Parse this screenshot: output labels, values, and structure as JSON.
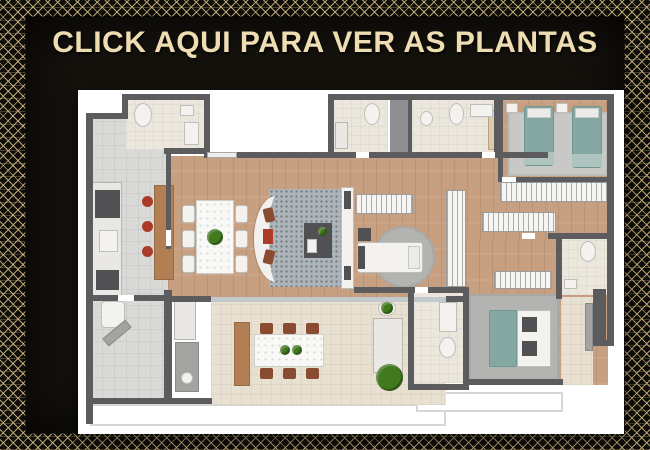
{
  "banner": {
    "cta_label": "CLICK AQUI PARA VER AS PLANTAS"
  },
  "palette": {
    "gold-text": "#efddb2",
    "gold-line": "#cbb47e",
    "panel-bg": "#16130e",
    "wall": "#5c5c5e",
    "wood": "#c79f81",
    "tile": "#d9d9d7",
    "bath": "#ece7dc",
    "terrace": "#e8e0d0",
    "bed-teal": "#86a8a2",
    "chair-brown": "#8a4c31",
    "stool-red": "#ab3a29",
    "plant-green": "#41791f",
    "wood-furniture": "#b17f53"
  },
  "floorplan": {
    "description": "apartment floor plan, top view",
    "items": [
      {
        "n": "balcony-apron-left",
        "t": "apron",
        "x": 12,
        "y": 314,
        "w": 356,
        "h": 22
      },
      {
        "n": "balcony-apron-right",
        "t": "apron",
        "x": 338,
        "y": 302,
        "w": 147,
        "h": 20
      },
      {
        "n": "entry-hall-floor",
        "t": "tile",
        "x": 12,
        "y": 27,
        "w": 114,
        "h": 37
      },
      {
        "n": "kitchen-floor",
        "t": "tile",
        "x": 12,
        "y": 27,
        "w": 80,
        "h": 185
      },
      {
        "n": "lavabo-floor",
        "t": "bath",
        "x": 48,
        "y": 8,
        "w": 80,
        "h": 52
      },
      {
        "n": "living-dining-floor",
        "t": "wood",
        "x": 90,
        "y": 66,
        "w": 446,
        "h": 146
      },
      {
        "n": "twin-bedroom-floor",
        "t": "wood",
        "x": 424,
        "y": 8,
        "w": 108,
        "h": 82
      },
      {
        "n": "master-suite-floor",
        "t": "wood",
        "x": 388,
        "y": 150,
        "w": 142,
        "h": 145
      },
      {
        "n": "service-area-floor",
        "t": "tile",
        "x": 12,
        "y": 200,
        "w": 76,
        "h": 112
      },
      {
        "n": "terrace-floor",
        "t": "terr",
        "x": 133,
        "y": 212,
        "w": 235,
        "h": 103
      },
      {
        "n": "bathroom1-floor",
        "t": "bath",
        "x": 255,
        "y": 10,
        "w": 55,
        "h": 54
      },
      {
        "n": "shaft",
        "t": "shaft",
        "x": 312,
        "y": 10,
        "w": 20,
        "h": 54
      },
      {
        "n": "bathroom2-floor",
        "t": "bath",
        "x": 334,
        "y": 10,
        "w": 82,
        "h": 54
      },
      {
        "n": "office-bathroom-floor",
        "t": "bath",
        "x": 334,
        "y": 200,
        "w": 52,
        "h": 93
      },
      {
        "n": "master-bathroom-floor",
        "t": "bath",
        "x": 481,
        "y": 147,
        "w": 51,
        "h": 58
      },
      {
        "n": "master-balcony-floor",
        "t": "terr",
        "x": 483,
        "y": 207,
        "w": 32,
        "h": 88
      },
      {
        "n": "living-rug",
        "t": "rugdot",
        "x": 191,
        "y": 99,
        "w": 76,
        "h": 98
      },
      {
        "n": "twin-bedroom-rug",
        "t": "ruggray",
        "x": 430,
        "y": 22,
        "w": 100,
        "h": 64
      },
      {
        "n": "office-rug",
        "t": "rugm",
        "x": 295,
        "y": 136,
        "w": 62,
        "h": 62,
        "r": "50%"
      },
      {
        "n": "master-rug",
        "t": "rugm",
        "x": 391,
        "y": 204,
        "w": 90,
        "h": 88
      },
      {
        "n": "terrace-sliding-door",
        "t": "glass",
        "x": 133,
        "y": 207,
        "w": 235,
        "h": 5
      },
      {
        "n": "toilet",
        "t": "white",
        "x": 56,
        "y": 13,
        "w": 18,
        "h": 24,
        "r": "50%"
      },
      {
        "n": "sink",
        "t": "white",
        "x": 102,
        "y": 15,
        "w": 14,
        "h": 11
      },
      {
        "n": "bathtub",
        "t": "white",
        "x": 106,
        "y": 32,
        "w": 15,
        "h": 23
      },
      {
        "n": "kitchen-counter",
        "t": "counter",
        "x": 14,
        "y": 92,
        "w": 30,
        "h": 116
      },
      {
        "n": "stove",
        "t": "dark",
        "x": 17,
        "y": 100,
        "w": 25,
        "h": 28
      },
      {
        "n": "kitchen-sink",
        "t": "white",
        "x": 21,
        "y": 140,
        "w": 19,
        "h": 22
      },
      {
        "n": "oven",
        "t": "dark",
        "x": 18,
        "y": 180,
        "w": 23,
        "h": 20
      },
      {
        "n": "kitchen-island",
        "t": "woodf",
        "x": 76,
        "y": 95,
        "w": 20,
        "h": 95
      },
      {
        "n": "stool",
        "t": "red",
        "x": 64,
        "y": 106,
        "w": 11,
        "h": 11,
        "r": "50%"
      },
      {
        "n": "stool",
        "t": "red",
        "x": 64,
        "y": 131,
        "w": 11,
        "h": 11,
        "r": "50%"
      },
      {
        "n": "stool",
        "t": "red",
        "x": 64,
        "y": 156,
        "w": 11,
        "h": 11,
        "r": "50%"
      },
      {
        "n": "dining-chair",
        "t": "white",
        "x": 104,
        "y": 115,
        "w": 13,
        "h": 18,
        "r": 3
      },
      {
        "n": "dining-chair",
        "t": "white",
        "x": 104,
        "y": 140,
        "w": 13,
        "h": 18,
        "r": 3
      },
      {
        "n": "dining-chair",
        "t": "white",
        "x": 104,
        "y": 165,
        "w": 13,
        "h": 18,
        "r": 3
      },
      {
        "n": "dining-chair",
        "t": "white",
        "x": 157,
        "y": 115,
        "w": 13,
        "h": 18,
        "r": 3
      },
      {
        "n": "dining-chair",
        "t": "white",
        "x": 157,
        "y": 140,
        "w": 13,
        "h": 18,
        "r": 3
      },
      {
        "n": "dining-chair",
        "t": "white",
        "x": 157,
        "y": 165,
        "w": 13,
        "h": 18,
        "r": 3
      },
      {
        "n": "dining-table",
        "t": "marble",
        "x": 118,
        "y": 110,
        "w": 38,
        "h": 74
      },
      {
        "n": "centerpiece-plant",
        "t": "green",
        "x": 129,
        "y": 139,
        "w": 16,
        "h": 16
      },
      {
        "n": "curved-sofa",
        "t": "sofa",
        "x": 176,
        "y": 106,
        "w": 44,
        "h": 86
      },
      {
        "n": "sofa-cushion",
        "t": "brown",
        "x": 186,
        "y": 118,
        "w": 10,
        "h": 14,
        "rot": -14
      },
      {
        "n": "sofa-cushion",
        "t": "red",
        "x": 185,
        "y": 139,
        "w": 10,
        "h": 15
      },
      {
        "n": "sofa-cushion",
        "t": "brown",
        "x": 186,
        "y": 160,
        "w": 10,
        "h": 14,
        "rot": 14
      },
      {
        "n": "armchair-set",
        "t": "dark",
        "x": 226,
        "y": 133,
        "w": 28,
        "h": 35
      },
      {
        "n": "side-plant",
        "t": "green",
        "x": 240,
        "y": 137,
        "w": 9,
        "h": 9
      },
      {
        "n": "coffee-table",
        "t": "white",
        "x": 229,
        "y": 149,
        "w": 10,
        "h": 14
      },
      {
        "n": "tv-panel",
        "t": "white",
        "x": 263,
        "y": 97,
        "w": 13,
        "h": 102
      },
      {
        "n": "tv",
        "t": "dark",
        "x": 266,
        "y": 101,
        "w": 7,
        "h": 18
      },
      {
        "n": "tv-console",
        "t": "dark",
        "x": 266,
        "y": 176,
        "w": 7,
        "h": 14
      },
      {
        "n": "wardrobe",
        "t": "hatch",
        "x": 277,
        "y": 104,
        "w": 58,
        "h": 20
      },
      {
        "n": "desk",
        "t": "dark",
        "x": 280,
        "y": 138,
        "w": 13,
        "h": 13
      },
      {
        "n": "single-bed",
        "t": "white",
        "x": 279,
        "y": 152,
        "w": 66,
        "h": 31,
        "r": 3
      },
      {
        "n": "bed-footboard",
        "t": "dark",
        "x": 280,
        "y": 156,
        "w": 7,
        "h": 23
      },
      {
        "n": "bed-pillow",
        "t": "pillow",
        "x": 330,
        "y": 156,
        "w": 12,
        "h": 23
      },
      {
        "n": "tall-closet",
        "t": "hatch",
        "x": 368,
        "y": 100,
        "w": 20,
        "h": 97
      },
      {
        "n": "dresser",
        "t": "woodlight",
        "x": 410,
        "y": 20,
        "w": 12,
        "h": 40
      },
      {
        "n": "twin-bed",
        "t": "teal",
        "x": 446,
        "y": 16,
        "w": 30,
        "h": 60,
        "r": 3
      },
      {
        "n": "bed-pillow",
        "t": "pillow",
        "x": 449,
        "y": 18,
        "w": 24,
        "h": 10
      },
      {
        "n": "bed-foot-blanket",
        "t": "tealL",
        "x": 446,
        "y": 62,
        "w": 30,
        "h": 13
      },
      {
        "n": "twin-bed",
        "t": "teal",
        "x": 494,
        "y": 16,
        "w": 30,
        "h": 62,
        "r": 3
      },
      {
        "n": "bed-pillow",
        "t": "pillow",
        "x": 497,
        "y": 18,
        "w": 24,
        "h": 10
      },
      {
        "n": "bed-foot-blanket",
        "t": "tealL",
        "x": 494,
        "y": 64,
        "w": 30,
        "h": 13
      },
      {
        "n": "nightstand",
        "t": "white",
        "x": 428,
        "y": 13,
        "w": 12,
        "h": 10
      },
      {
        "n": "nightstand",
        "t": "white",
        "x": 478,
        "y": 13,
        "w": 12,
        "h": 10
      },
      {
        "n": "wardrobe",
        "t": "hatch",
        "x": 422,
        "y": 92,
        "w": 109,
        "h": 20
      },
      {
        "n": "wardrobe",
        "t": "hatch",
        "x": 404,
        "y": 122,
        "w": 74,
        "h": 20
      },
      {
        "n": "toilet",
        "t": "white",
        "x": 286,
        "y": 13,
        "w": 16,
        "h": 22,
        "r": "50%"
      },
      {
        "n": "shower",
        "t": "counter",
        "x": 257,
        "y": 32,
        "w": 13,
        "h": 27
      },
      {
        "n": "sink",
        "t": "white",
        "x": 342,
        "y": 21,
        "w": 13,
        "h": 15,
        "r": "50%"
      },
      {
        "n": "toilet",
        "t": "white",
        "x": 371,
        "y": 13,
        "w": 15,
        "h": 22,
        "r": "50%"
      },
      {
        "n": "vanity-counter",
        "t": "white",
        "x": 392,
        "y": 14,
        "w": 23,
        "h": 13
      },
      {
        "n": "vanity-counter",
        "t": "white",
        "x": 361,
        "y": 212,
        "w": 18,
        "h": 30
      },
      {
        "n": "toilet",
        "t": "white",
        "x": 361,
        "y": 247,
        "w": 17,
        "h": 21,
        "r": "50%"
      },
      {
        "n": "toilet",
        "t": "white",
        "x": 502,
        "y": 151,
        "w": 16,
        "h": 21,
        "r": "50%"
      },
      {
        "n": "sink",
        "t": "white",
        "x": 486,
        "y": 189,
        "w": 13,
        "h": 10
      },
      {
        "n": "wardrobe",
        "t": "hatch",
        "x": 416,
        "y": 181,
        "w": 58,
        "h": 18
      },
      {
        "n": "double-bed-duvet",
        "t": "teal",
        "x": 411,
        "y": 220,
        "w": 28,
        "h": 57,
        "r": 2
      },
      {
        "n": "double-bed",
        "t": "white",
        "x": 439,
        "y": 220,
        "w": 34,
        "h": 57
      },
      {
        "n": "bed-cushion",
        "t": "dark",
        "x": 444,
        "y": 227,
        "w": 15,
        "h": 15
      },
      {
        "n": "bed-cushion",
        "t": "dark",
        "x": 444,
        "y": 251,
        "w": 15,
        "h": 15
      },
      {
        "n": "balcony-bench",
        "t": "gray",
        "x": 507,
        "y": 213,
        "w": 8,
        "h": 48
      },
      {
        "n": "laundry-sink",
        "t": "white",
        "x": 23,
        "y": 211,
        "w": 24,
        "h": 27,
        "r": 4
      },
      {
        "n": "ironing-board",
        "t": "gray",
        "x": 24,
        "y": 238,
        "w": 30,
        "h": 10,
        "rot": -40
      },
      {
        "n": "cabinet",
        "t": "counter",
        "x": 96,
        "y": 206,
        "w": 22,
        "h": 44
      },
      {
        "n": "water-heater",
        "t": "gray",
        "x": 97,
        "y": 252,
        "w": 24,
        "h": 50
      },
      {
        "n": "heater-dial",
        "t": "white",
        "x": 103,
        "y": 282,
        "w": 12,
        "h": 12,
        "r": "50%"
      },
      {
        "n": "sideboard",
        "t": "woodf",
        "x": 156,
        "y": 232,
        "w": 16,
        "h": 64
      },
      {
        "n": "terrace-chair",
        "t": "brown",
        "x": 182,
        "y": 233,
        "w": 13,
        "h": 11
      },
      {
        "n": "terrace-chair",
        "t": "brown",
        "x": 205,
        "y": 233,
        "w": 13,
        "h": 11
      },
      {
        "n": "terrace-chair",
        "t": "brown",
        "x": 228,
        "y": 233,
        "w": 13,
        "h": 11
      },
      {
        "n": "terrace-table",
        "t": "marble",
        "x": 176,
        "y": 244,
        "w": 70,
        "h": 33
      },
      {
        "n": "terrace-chair",
        "t": "brown",
        "x": 182,
        "y": 278,
        "w": 13,
        "h": 11
      },
      {
        "n": "terrace-chair",
        "t": "brown",
        "x": 205,
        "y": 278,
        "w": 13,
        "h": 11
      },
      {
        "n": "terrace-chair",
        "t": "brown",
        "x": 228,
        "y": 278,
        "w": 13,
        "h": 11
      },
      {
        "n": "table-plant",
        "t": "green",
        "x": 202,
        "y": 255,
        "w": 10,
        "h": 10
      },
      {
        "n": "table-plant",
        "t": "green",
        "x": 214,
        "y": 255,
        "w": 10,
        "h": 10
      },
      {
        "n": "lounge-chair",
        "t": "counter",
        "x": 295,
        "y": 228,
        "w": 30,
        "h": 55
      },
      {
        "n": "side-table",
        "t": "white",
        "x": 300,
        "y": 211,
        "w": 18,
        "h": 15,
        "r": "50%"
      },
      {
        "n": "potted-plant",
        "t": "green",
        "x": 303,
        "y": 212,
        "w": 12,
        "h": 12
      },
      {
        "n": "large-plant",
        "t": "green",
        "x": 298,
        "y": 274,
        "w": 27,
        "h": 27
      },
      {
        "n": "wall",
        "t": "wall",
        "x": 44,
        "y": 4,
        "w": 88,
        "h": 6
      },
      {
        "n": "wall",
        "t": "wall",
        "x": 126,
        "y": 4,
        "w": 6,
        "h": 60
      },
      {
        "n": "wall",
        "t": "wall",
        "x": 86,
        "y": 58,
        "w": 46,
        "h": 6
      },
      {
        "n": "wall",
        "t": "wall",
        "x": 44,
        "y": 4,
        "w": 6,
        "h": 25
      },
      {
        "n": "wall",
        "t": "wall",
        "x": 8,
        "y": 23,
        "w": 42,
        "h": 6
      },
      {
        "n": "wall",
        "t": "wall",
        "x": 8,
        "y": 23,
        "w": 7,
        "h": 311
      },
      {
        "n": "wall",
        "t": "wall",
        "x": 126,
        "y": 62,
        "w": 344,
        "h": 6
      },
      {
        "n": "wall",
        "t": "wall",
        "x": 250,
        "y": 4,
        "w": 286,
        "h": 6
      },
      {
        "n": "wall",
        "t": "wall",
        "x": 529,
        "y": 4,
        "w": 7,
        "h": 250
      },
      {
        "n": "wall",
        "t": "wall",
        "x": 250,
        "y": 4,
        "w": 6,
        "h": 64
      },
      {
        "n": "wall",
        "t": "wall",
        "x": 330,
        "y": 10,
        "w": 4,
        "h": 54
      },
      {
        "n": "wall",
        "t": "wall",
        "x": 416,
        "y": 10,
        "w": 4,
        "h": 54
      },
      {
        "n": "wall",
        "t": "wall",
        "x": 420,
        "y": 4,
        "w": 5,
        "h": 88
      },
      {
        "n": "wall",
        "t": "wall",
        "x": 420,
        "y": 87,
        "w": 116,
        "h": 5
      },
      {
        "n": "wall",
        "t": "wall",
        "x": 88,
        "y": 64,
        "w": 5,
        "h": 95
      },
      {
        "n": "wall",
        "t": "wall",
        "x": 8,
        "y": 205,
        "w": 82,
        "h": 6
      },
      {
        "n": "wall",
        "t": "wall",
        "x": 86,
        "y": 200,
        "w": 8,
        "h": 112
      },
      {
        "n": "wall",
        "t": "wall",
        "x": 8,
        "y": 308,
        "w": 126,
        "h": 6
      },
      {
        "n": "wall",
        "t": "wall",
        "x": 90,
        "y": 206,
        "w": 43,
        "h": 6
      },
      {
        "n": "wall",
        "t": "wall",
        "x": 368,
        "y": 206,
        "w": 20,
        "h": 6
      },
      {
        "n": "wall",
        "t": "wall",
        "x": 276,
        "y": 197,
        "w": 112,
        "h": 6
      },
      {
        "n": "wall",
        "t": "wall",
        "x": 330,
        "y": 197,
        "w": 6,
        "h": 103
      },
      {
        "n": "wall",
        "t": "wall",
        "x": 385,
        "y": 197,
        "w": 6,
        "h": 103
      },
      {
        "n": "wall",
        "t": "wall",
        "x": 330,
        "y": 294,
        "w": 61,
        "h": 6
      },
      {
        "n": "wall",
        "t": "wall",
        "x": 385,
        "y": 289,
        "w": 100,
        "h": 6
      },
      {
        "n": "wall",
        "t": "wall",
        "x": 478,
        "y": 147,
        "w": 6,
        "h": 62
      },
      {
        "n": "wall",
        "t": "wall",
        "x": 470,
        "y": 143,
        "w": 66,
        "h": 6
      },
      {
        "n": "wall",
        "t": "wall",
        "x": 515,
        "y": 199,
        "w": 13,
        "h": 56
      },
      {
        "n": "wall",
        "t": "wall",
        "x": 515,
        "y": 250,
        "w": 21,
        "h": 6
      },
      {
        "n": "window",
        "t": "win",
        "x": 129,
        "y": 62,
        "w": 30,
        "h": 6
      },
      {
        "n": "door-opening",
        "t": "door",
        "x": 278,
        "y": 62,
        "w": 13,
        "h": 6
      },
      {
        "n": "door-opening",
        "t": "door",
        "x": 404,
        "y": 62,
        "w": 13,
        "h": 6
      },
      {
        "n": "door-opening",
        "t": "door",
        "x": 424,
        "y": 87,
        "w": 14,
        "h": 5
      },
      {
        "n": "door-opening",
        "t": "door",
        "x": 40,
        "y": 205,
        "w": 16,
        "h": 6
      },
      {
        "n": "door-opening",
        "t": "door",
        "x": 444,
        "y": 143,
        "w": 13,
        "h": 6
      },
      {
        "n": "door-opening",
        "t": "door",
        "x": 88,
        "y": 140,
        "w": 5,
        "h": 16
      },
      {
        "n": "door-opening",
        "t": "door",
        "x": 337,
        "y": 197,
        "w": 13,
        "h": 6
      }
    ]
  }
}
